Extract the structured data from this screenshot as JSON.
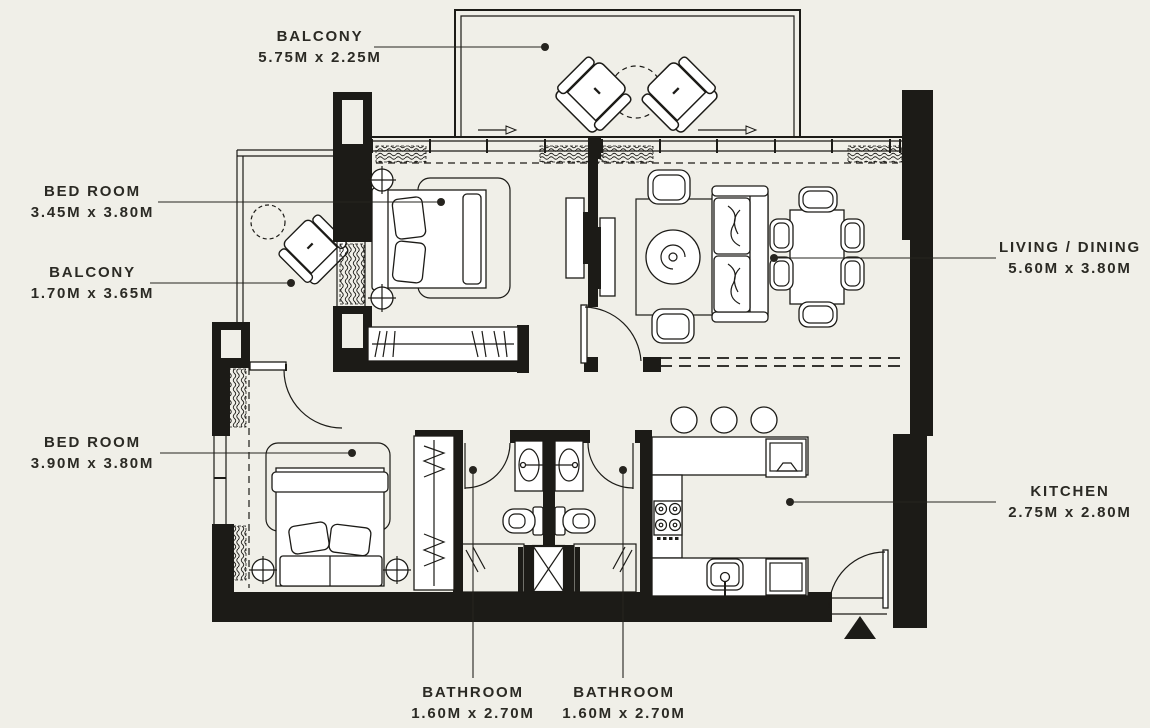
{
  "colors": {
    "background": "#f0efe8",
    "ink": "#1c1b17",
    "furniture_fill": "#ffffff",
    "label_text": "#2b2a24"
  },
  "rooms": [
    {
      "id": "balcony-top",
      "name": "BALCONY",
      "dims": "5.75M x 2.25M"
    },
    {
      "id": "bedroom-1",
      "name": "BED ROOM",
      "dims": "3.45M x 3.80M"
    },
    {
      "id": "balcony-left",
      "name": "BALCONY",
      "dims": "1.70M x 3.65M"
    },
    {
      "id": "living-dining",
      "name": "LIVING / DINING",
      "dims": "5.60M x 3.80M"
    },
    {
      "id": "bedroom-2",
      "name": "BED ROOM",
      "dims": "3.90M x 3.80M"
    },
    {
      "id": "kitchen",
      "name": "KITCHEN",
      "dims": "2.75M x 2.80M"
    },
    {
      "id": "bathroom-1",
      "name": "BATHROOM",
      "dims": "1.60M x 2.70M"
    },
    {
      "id": "bathroom-2",
      "name": "BATHROOM",
      "dims": "1.60M x 2.70M"
    }
  ]
}
